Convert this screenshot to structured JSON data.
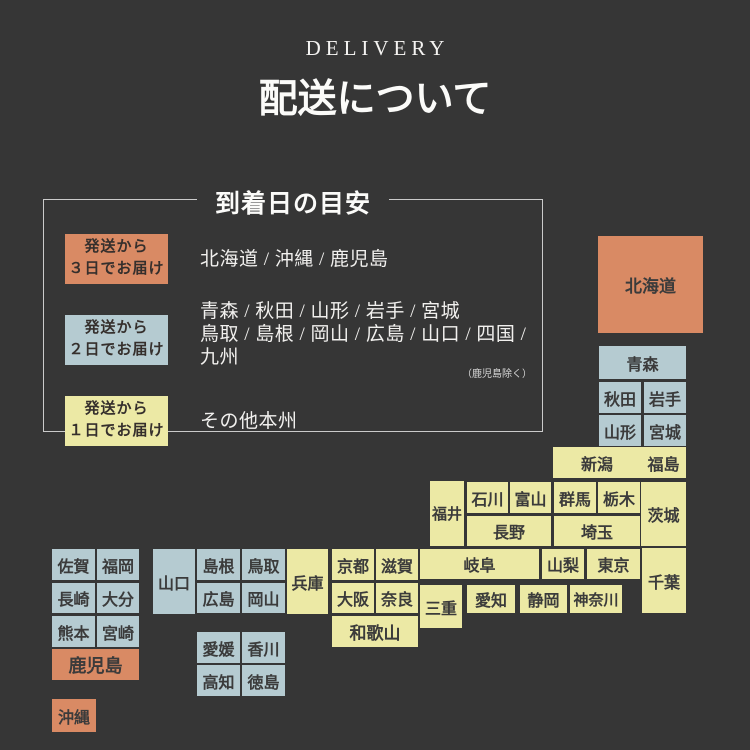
{
  "header": {
    "eyebrow": "DELIVERY",
    "title": "配送について"
  },
  "legend": {
    "title": "到着日の目安",
    "items": [
      {
        "color": "orange",
        "badge_line1": "発送から",
        "badge_line2": "３日でお届け",
        "desc_lines": [
          "北海道 / 沖縄 / 鹿児島"
        ],
        "note": ""
      },
      {
        "color": "blue",
        "badge_line1": "発送から",
        "badge_line2": "２日でお届け",
        "desc_lines": [
          "青森 / 秋田 / 山形 / 岩手 / 宮城",
          "鳥取 / 島根 / 岡山 / 広島 / 山口 / 四国 / 九州"
        ],
        "note": "（鹿児島除く）"
      },
      {
        "color": "yellow",
        "badge_line1": "発送から",
        "badge_line2": "１日でお届け",
        "desc_lines": [
          "その他本州"
        ],
        "note": ""
      }
    ]
  },
  "colors": {
    "background": "#363636",
    "orange": "#d98a64",
    "blue": "#b5cbd1",
    "yellow": "#ece9a5",
    "tile_text": "#3b3b3b",
    "light_text": "#f4f3f1"
  },
  "map": {
    "tiles": [
      {
        "id": "hokkaido",
        "label": "北海道",
        "x": 598,
        "y": 236,
        "w": 105,
        "h": 97,
        "color": "orange",
        "fs": 17
      },
      {
        "id": "aomori",
        "label": "青森",
        "x": 599,
        "y": 346,
        "w": 87,
        "h": 33,
        "color": "blue"
      },
      {
        "id": "akita",
        "label": "秋田",
        "x": 599,
        "y": 382,
        "w": 42,
        "h": 31,
        "color": "blue"
      },
      {
        "id": "iwate",
        "label": "岩手",
        "x": 644,
        "y": 382,
        "w": 42,
        "h": 31,
        "color": "blue"
      },
      {
        "id": "yamagata",
        "label": "山形",
        "x": 599,
        "y": 415,
        "w": 42,
        "h": 31,
        "color": "blue"
      },
      {
        "id": "miyagi",
        "label": "宮城",
        "x": 644,
        "y": 415,
        "w": 42,
        "h": 31,
        "color": "blue"
      },
      {
        "id": "niigata",
        "label": "新潟",
        "x": 553,
        "y": 447,
        "w": 88,
        "h": 31,
        "color": "yellow"
      },
      {
        "id": "fukushima",
        "label": "福島",
        "x": 641,
        "y": 447,
        "w": 45,
        "h": 31,
        "color": "yellow"
      },
      {
        "id": "fukui",
        "label": "福井",
        "x": 430,
        "y": 481,
        "w": 34,
        "h": 65,
        "color": "yellow",
        "fs": 15
      },
      {
        "id": "ishikawa",
        "label": "石川",
        "x": 467,
        "y": 482,
        "w": 41,
        "h": 31,
        "color": "yellow"
      },
      {
        "id": "toyama",
        "label": "富山",
        "x": 510,
        "y": 482,
        "w": 41,
        "h": 31,
        "color": "yellow"
      },
      {
        "id": "gunma",
        "label": "群馬",
        "x": 554,
        "y": 482,
        "w": 42,
        "h": 31,
        "color": "yellow"
      },
      {
        "id": "tochigi",
        "label": "栃木",
        "x": 598,
        "y": 482,
        "w": 42,
        "h": 31,
        "color": "yellow"
      },
      {
        "id": "ibaraki",
        "label": "茨城",
        "x": 641,
        "y": 482,
        "w": 45,
        "h": 64,
        "color": "yellow"
      },
      {
        "id": "nagano",
        "label": "長野",
        "x": 467,
        "y": 516,
        "w": 84,
        "h": 30,
        "color": "yellow"
      },
      {
        "id": "saitama",
        "label": "埼玉",
        "x": 554,
        "y": 516,
        "w": 86,
        "h": 30,
        "color": "yellow"
      },
      {
        "id": "gifu",
        "label": "岐阜",
        "x": 420,
        "y": 549,
        "w": 119,
        "h": 30,
        "color": "yellow"
      },
      {
        "id": "yamanashi",
        "label": "山梨",
        "x": 542,
        "y": 549,
        "w": 42,
        "h": 30,
        "color": "yellow"
      },
      {
        "id": "tokyo",
        "label": "東京",
        "x": 587,
        "y": 549,
        "w": 53,
        "h": 30,
        "color": "yellow"
      },
      {
        "id": "chiba",
        "label": "千葉",
        "x": 642,
        "y": 548,
        "w": 44,
        "h": 65,
        "color": "yellow"
      },
      {
        "id": "mie",
        "label": "三重",
        "x": 420,
        "y": 585,
        "w": 42,
        "h": 43,
        "color": "yellow"
      },
      {
        "id": "aichi",
        "label": "愛知",
        "x": 467,
        "y": 585,
        "w": 48,
        "h": 28,
        "color": "yellow"
      },
      {
        "id": "shizuoka",
        "label": "静岡",
        "x": 520,
        "y": 585,
        "w": 47,
        "h": 28,
        "color": "yellow"
      },
      {
        "id": "kanagawa",
        "label": "神奈川",
        "x": 570,
        "y": 585,
        "w": 52,
        "h": 28,
        "color": "yellow",
        "fs": 15
      },
      {
        "id": "hyogo",
        "label": "兵庫",
        "x": 287,
        "y": 549,
        "w": 41,
        "h": 65,
        "color": "yellow"
      },
      {
        "id": "kyoto",
        "label": "京都",
        "x": 332,
        "y": 549,
        "w": 42,
        "h": 31,
        "color": "yellow"
      },
      {
        "id": "shiga",
        "label": "滋賀",
        "x": 376,
        "y": 549,
        "w": 42,
        "h": 31,
        "color": "yellow"
      },
      {
        "id": "osaka",
        "label": "大阪",
        "x": 332,
        "y": 583,
        "w": 42,
        "h": 30,
        "color": "yellow"
      },
      {
        "id": "nara",
        "label": "奈良",
        "x": 376,
        "y": 583,
        "w": 42,
        "h": 30,
        "color": "yellow"
      },
      {
        "id": "wakayama",
        "label": "和歌山",
        "x": 332,
        "y": 616,
        "w": 86,
        "h": 31,
        "color": "yellow",
        "fs": 17
      },
      {
        "id": "yamaguchi",
        "label": "山口",
        "x": 153,
        "y": 549,
        "w": 42,
        "h": 65,
        "color": "blue"
      },
      {
        "id": "shimane",
        "label": "島根",
        "x": 197,
        "y": 549,
        "w": 43,
        "h": 31,
        "color": "blue"
      },
      {
        "id": "tottori",
        "label": "鳥取",
        "x": 242,
        "y": 549,
        "w": 43,
        "h": 31,
        "color": "blue"
      },
      {
        "id": "hiroshima",
        "label": "広島",
        "x": 197,
        "y": 583,
        "w": 43,
        "h": 30,
        "color": "blue"
      },
      {
        "id": "okayama",
        "label": "岡山",
        "x": 242,
        "y": 583,
        "w": 43,
        "h": 30,
        "color": "blue"
      },
      {
        "id": "ehime",
        "label": "愛媛",
        "x": 197,
        "y": 632,
        "w": 43,
        "h": 31,
        "color": "blue"
      },
      {
        "id": "kagawa",
        "label": "香川",
        "x": 242,
        "y": 632,
        "w": 43,
        "h": 31,
        "color": "blue"
      },
      {
        "id": "kochi",
        "label": "高知",
        "x": 197,
        "y": 665,
        "w": 43,
        "h": 31,
        "color": "blue"
      },
      {
        "id": "tokushima",
        "label": "徳島",
        "x": 242,
        "y": 665,
        "w": 43,
        "h": 31,
        "color": "blue"
      },
      {
        "id": "saga",
        "label": "佐賀",
        "x": 52,
        "y": 549,
        "w": 43,
        "h": 31,
        "color": "blue"
      },
      {
        "id": "fukuoka",
        "label": "福岡",
        "x": 97,
        "y": 549,
        "w": 42,
        "h": 31,
        "color": "blue"
      },
      {
        "id": "nagasaki",
        "label": "長崎",
        "x": 52,
        "y": 583,
        "w": 43,
        "h": 30,
        "color": "blue"
      },
      {
        "id": "oita",
        "label": "大分",
        "x": 97,
        "y": 583,
        "w": 42,
        "h": 30,
        "color": "blue"
      },
      {
        "id": "kumamoto",
        "label": "熊本",
        "x": 52,
        "y": 616,
        "w": 43,
        "h": 31,
        "color": "blue"
      },
      {
        "id": "miyazaki",
        "label": "宮崎",
        "x": 97,
        "y": 616,
        "w": 42,
        "h": 31,
        "color": "blue"
      },
      {
        "id": "kagoshima",
        "label": "鹿児島",
        "x": 52,
        "y": 649,
        "w": 87,
        "h": 31,
        "color": "orange",
        "fs": 18
      },
      {
        "id": "okinawa",
        "label": "沖縄",
        "x": 52,
        "y": 699,
        "w": 44,
        "h": 33,
        "color": "orange"
      }
    ]
  }
}
